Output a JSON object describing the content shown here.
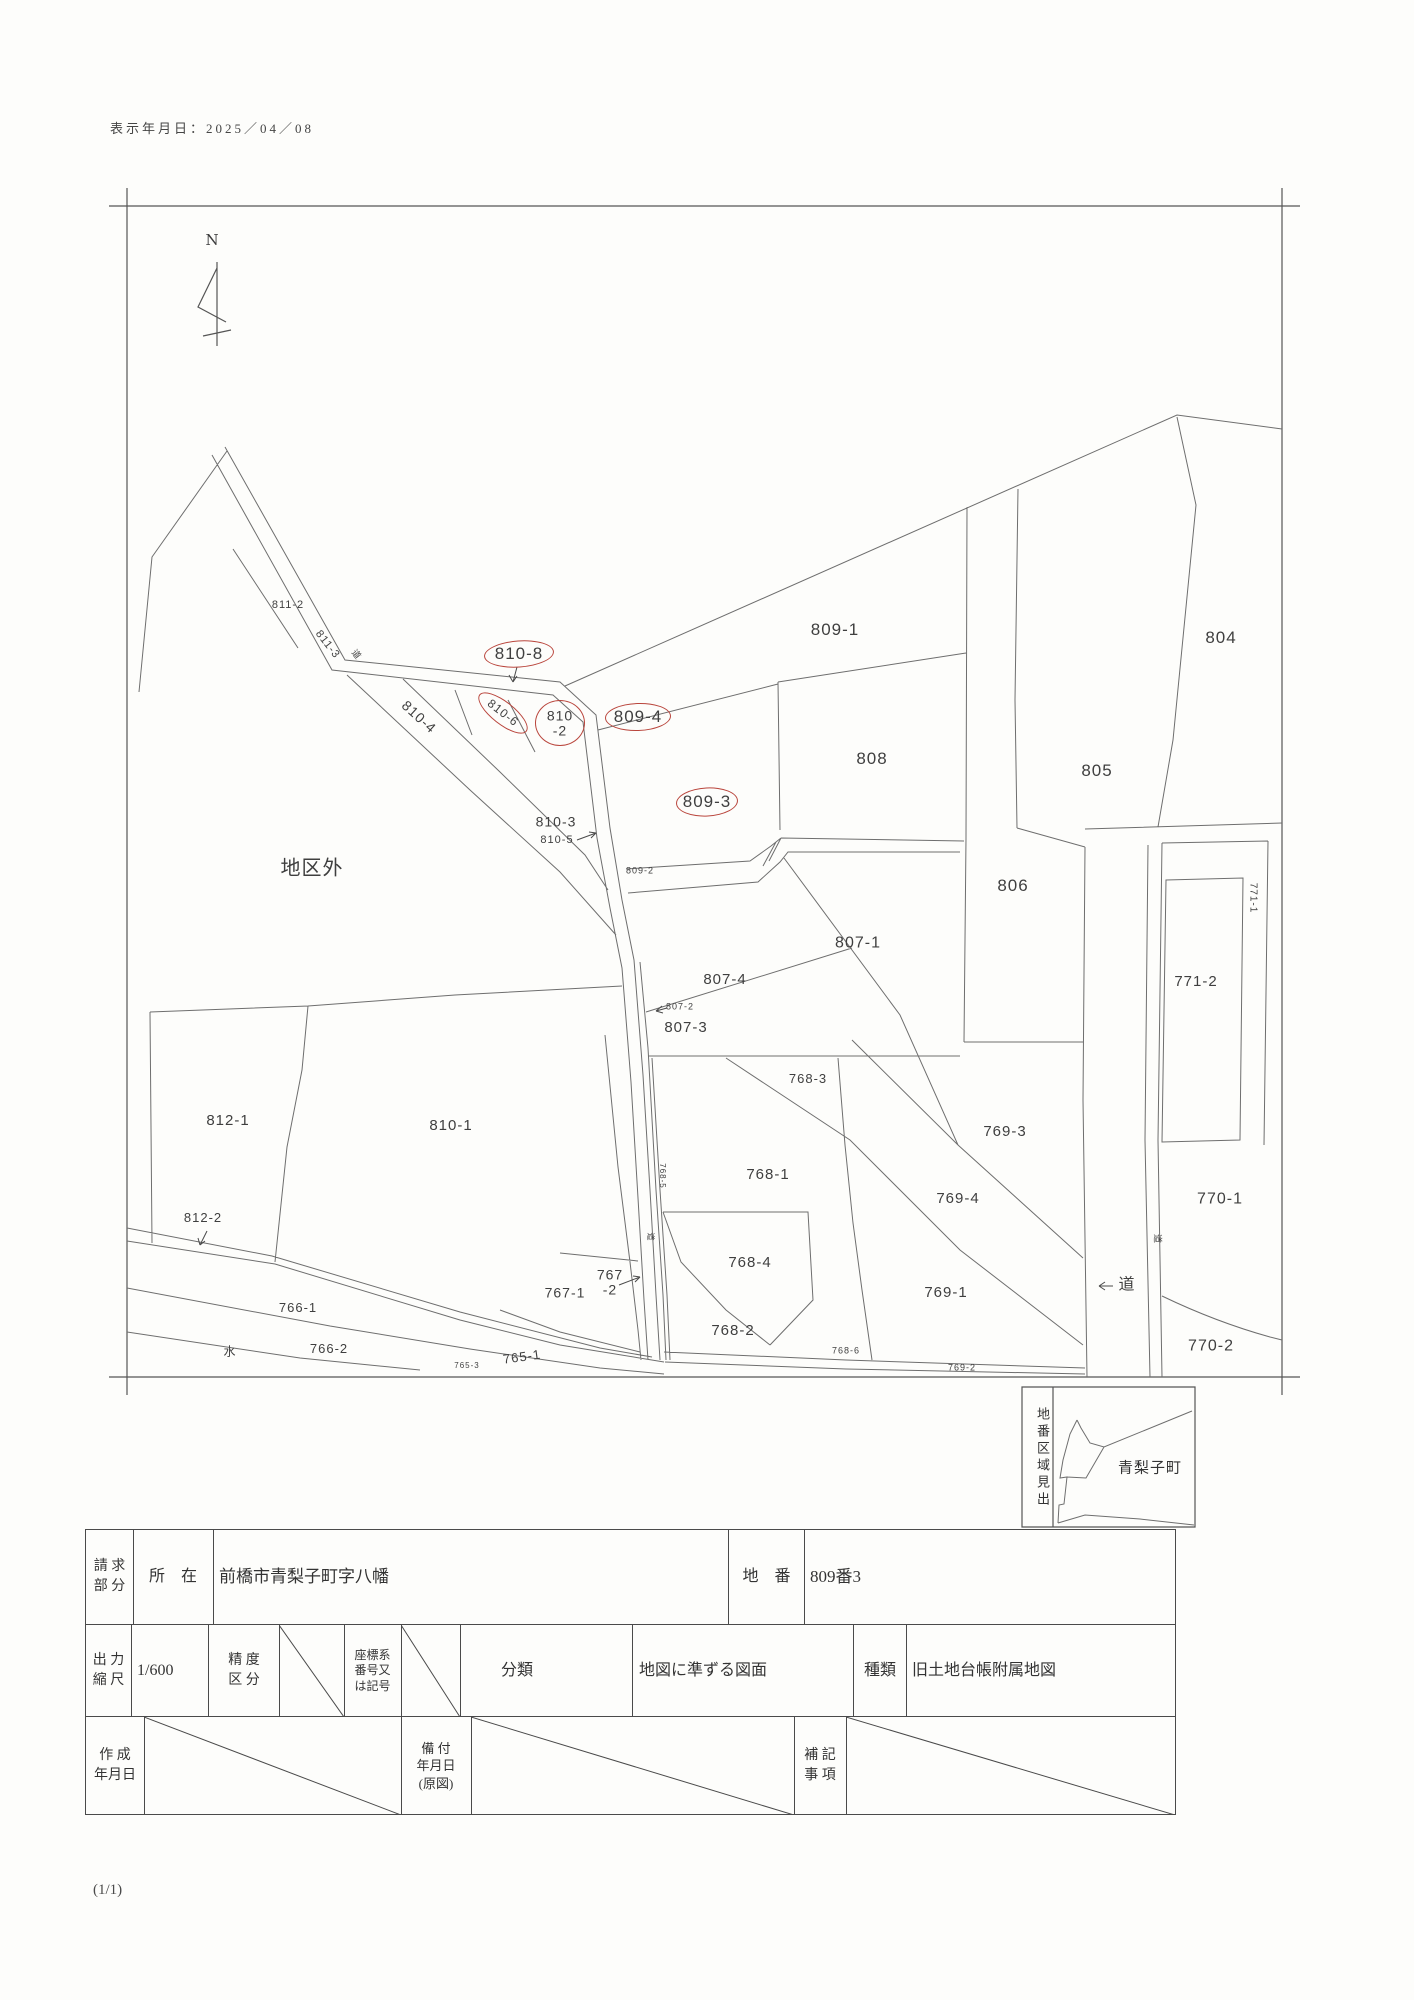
{
  "page": {
    "display_date": "表示年月日：2025／04／08",
    "page_indicator": "(1/1)"
  },
  "map": {
    "north_label": "N",
    "red_circle_color": "#b9453c",
    "labels": [
      {
        "t": "811-2",
        "x": 288,
        "y": 606,
        "s": 11,
        "n": "parcel-label-811-2"
      },
      {
        "t": "811-3",
        "x": 327,
        "y": 645,
        "s": 11,
        "r": 52,
        "n": "parcel-label-811-3"
      },
      {
        "t": "道",
        "x": 356,
        "y": 655,
        "s": 9,
        "r": 52,
        "n": "road-label"
      },
      {
        "t": "810-8",
        "x": 519,
        "y": 654,
        "s": 17,
        "c": 1,
        "ew": 68,
        "eh": 25,
        "r2": -4,
        "n": "parcel-label-810-8"
      },
      {
        "t": "810-6",
        "x": 503,
        "y": 713,
        "s": 12,
        "r": 38,
        "c": 1,
        "ew": 58,
        "eh": 21,
        "r2": 38,
        "n": "parcel-label-810-6"
      },
      {
        "t": "810\n-2",
        "x": 560,
        "y": 723,
        "s": 14,
        "c": 1,
        "ew": 48,
        "eh": 44,
        "n": "parcel-label-810-2"
      },
      {
        "t": "809-4",
        "x": 638,
        "y": 717,
        "s": 17,
        "c": 1,
        "ew": 64,
        "eh": 26,
        "r2": -2,
        "n": "parcel-label-809-4"
      },
      {
        "t": "809-3",
        "x": 707,
        "y": 802,
        "s": 17,
        "c": 1,
        "ew": 60,
        "eh": 27,
        "r2": -3,
        "n": "parcel-label-809-3"
      },
      {
        "t": "810-4",
        "x": 419,
        "y": 717,
        "s": 14,
        "r": 42,
        "n": "parcel-label-810-4"
      },
      {
        "t": "810-3",
        "x": 556,
        "y": 822,
        "s": 14,
        "n": "parcel-label-810-3"
      },
      {
        "t": "810-5",
        "x": 557,
        "y": 841,
        "s": 11,
        "n": "parcel-label-810-5"
      },
      {
        "t": "809-2",
        "x": 640,
        "y": 871,
        "s": 9,
        "n": "parcel-label-809-2"
      },
      {
        "t": "地区外",
        "x": 312,
        "y": 869,
        "s": 20,
        "n": "outside-district-label"
      },
      {
        "t": "809-1",
        "x": 835,
        "y": 630,
        "s": 17,
        "n": "parcel-label-809-1"
      },
      {
        "t": "804",
        "x": 1221,
        "y": 638,
        "s": 17,
        "n": "parcel-label-804"
      },
      {
        "t": "805",
        "x": 1097,
        "y": 771,
        "s": 17,
        "n": "parcel-label-805"
      },
      {
        "t": "808",
        "x": 872,
        "y": 759,
        "s": 17,
        "n": "parcel-label-808"
      },
      {
        "t": "806",
        "x": 1013,
        "y": 886,
        "s": 17,
        "n": "parcel-label-806"
      },
      {
        "t": "807-1",
        "x": 858,
        "y": 944,
        "s": 16,
        "n": "parcel-label-807-1"
      },
      {
        "t": "807-4",
        "x": 725,
        "y": 980,
        "s": 15,
        "n": "parcel-label-807-4"
      },
      {
        "t": "807-2",
        "x": 680,
        "y": 1007,
        "s": 9,
        "n": "parcel-label-807-2"
      },
      {
        "t": "807-3",
        "x": 686,
        "y": 1028,
        "s": 15,
        "n": "parcel-label-807-3"
      },
      {
        "t": "771-1",
        "x": 1252,
        "y": 898,
        "s": 10,
        "r": 90,
        "n": "parcel-label-771-1"
      },
      {
        "t": "771-2",
        "x": 1196,
        "y": 982,
        "s": 15,
        "n": "parcel-label-771-2"
      },
      {
        "t": "768-3",
        "x": 808,
        "y": 1079,
        "s": 13,
        "n": "parcel-label-768-3"
      },
      {
        "t": "769-3",
        "x": 1005,
        "y": 1132,
        "s": 15,
        "n": "parcel-label-769-3"
      },
      {
        "t": "768-1",
        "x": 768,
        "y": 1175,
        "s": 15,
        "n": "parcel-label-768-1"
      },
      {
        "t": "768-5",
        "x": 662,
        "y": 1176,
        "s": 8,
        "r": 90,
        "n": "parcel-label-768-5"
      },
      {
        "t": "769-4",
        "x": 958,
        "y": 1199,
        "s": 15,
        "n": "parcel-label-769-4"
      },
      {
        "t": "770-1",
        "x": 1220,
        "y": 1200,
        "s": 16,
        "n": "parcel-label-770-1"
      },
      {
        "t": "道",
        "x": 1157,
        "y": 1239,
        "s": 9,
        "r": 90,
        "n": "road-label"
      },
      {
        "t": "道",
        "x": 650,
        "y": 1237,
        "s": 8,
        "r": 90,
        "n": "road-label"
      },
      {
        "t": "812-1",
        "x": 228,
        "y": 1121,
        "s": 15,
        "n": "parcel-label-812-1"
      },
      {
        "t": "810-1",
        "x": 451,
        "y": 1126,
        "s": 15,
        "n": "parcel-label-810-1"
      },
      {
        "t": "812-2",
        "x": 203,
        "y": 1218,
        "s": 13,
        "n": "parcel-label-812-2"
      },
      {
        "t": "767-1",
        "x": 565,
        "y": 1293,
        "s": 14,
        "n": "parcel-label-767-1"
      },
      {
        "t": "767\n-2",
        "x": 610,
        "y": 1282,
        "s": 14,
        "n": "parcel-label-767-2"
      },
      {
        "t": "768-4",
        "x": 750,
        "y": 1263,
        "s": 15,
        "n": "parcel-label-768-4"
      },
      {
        "t": "769-1",
        "x": 946,
        "y": 1293,
        "s": 15,
        "n": "parcel-label-769-1"
      },
      {
        "t": "道",
        "x": 1127,
        "y": 1286,
        "s": 16,
        "n": "road-label"
      },
      {
        "t": "770-2",
        "x": 1211,
        "y": 1347,
        "s": 16,
        "n": "parcel-label-770-2"
      },
      {
        "t": "766-1",
        "x": 298,
        "y": 1308,
        "s": 13,
        "n": "parcel-label-766-1"
      },
      {
        "t": "水",
        "x": 230,
        "y": 1352,
        "s": 12,
        "n": "water-label"
      },
      {
        "t": "766-2",
        "x": 329,
        "y": 1349,
        "s": 13,
        "n": "parcel-label-766-2"
      },
      {
        "t": "765-1",
        "x": 522,
        "y": 1357,
        "s": 13,
        "r": -8,
        "n": "parcel-label-765-1"
      },
      {
        "t": "765-3",
        "x": 467,
        "y": 1366,
        "s": 8,
        "n": "parcel-label-765-3"
      },
      {
        "t": "768-2",
        "x": 733,
        "y": 1331,
        "s": 15,
        "n": "parcel-label-768-2"
      },
      {
        "t": "768-6",
        "x": 846,
        "y": 1351,
        "s": 9,
        "n": "parcel-label-768-6"
      },
      {
        "t": "769-2",
        "x": 962,
        "y": 1368,
        "s": 9,
        "n": "parcel-label-769-2"
      }
    ]
  },
  "legend": {
    "vertical_title": "地番区域見出",
    "area_label": "青梨子町"
  },
  "table": {
    "row1": {
      "c1": "請 求\n部 分",
      "c2": "所　在",
      "c3": "前橋市青梨子町字八幡",
      "c4": "地　番",
      "c5": "809番3"
    },
    "row2": {
      "c1": "出 力\n縮 尺",
      "c2": "1/600",
      "c3": "精 度\n区 分",
      "c4": "座標系\n番号又\nは記号",
      "c5": "分類",
      "c6": "地図に準ずる図面",
      "c7": "種類",
      "c8": "旧土地台帳附属地図"
    },
    "row3": {
      "c1": "作 成\n年月日",
      "c2": "備 付\n年月日\n(原図)",
      "c3": "補 記\n事 項"
    }
  }
}
